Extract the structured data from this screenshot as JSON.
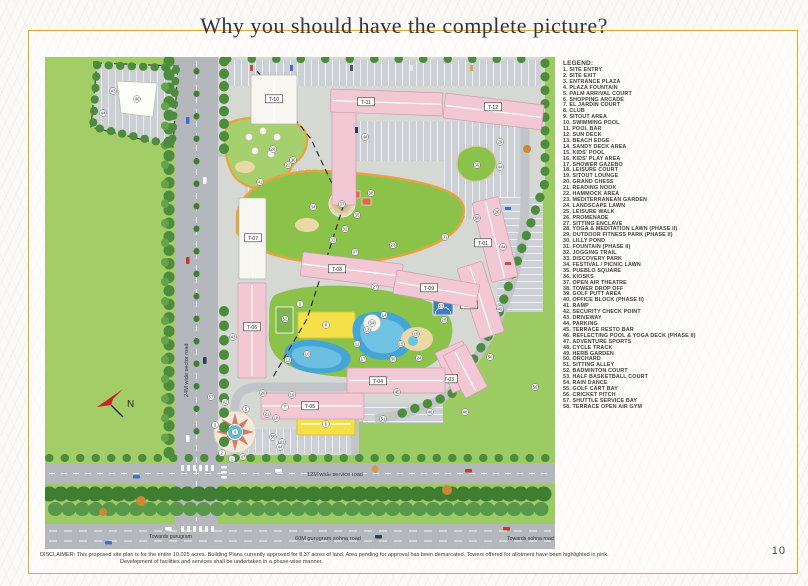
{
  "page": {
    "title": "Why you should have the complete picture?",
    "page_number": "10",
    "disclaimer": {
      "line1": "DISCLAIMER: This proposed site plan is for the entire 10.025 acres. Building Plans currently approved for 8.37 acres of land. Area pending for approval has been demarcated. Towers offered for allotment have been highlighted in pink.",
      "line2": "Development of facilities and services shall be undertaken in a phase-wise manner."
    }
  },
  "legend": {
    "heading": "LEGEND:",
    "items": [
      "1. SITE ENTRY",
      "2. SITE EXIT",
      "3. ENTRANCE PLAZA",
      "4. PLAZA FOUNTAIN",
      "5. PALM ARRIVAL COURT",
      "6. SHOPPING ARCADE",
      "7. EL JARDIN COURT",
      "8. CLUB",
      "9. SITOUT AREA",
      "10. SWIMMING POOL",
      "11. POOL BAR",
      "12. SUN DECK",
      "13. BEACH EDGE",
      "14. SANDY DECK AREA",
      "15. KIDS' POOL",
      "16. KIDS' PLAY AREA",
      "17. SHOWER GAZEBO",
      "18. LEISURE COURT",
      "19. SITOUT LOUNGE",
      "20. GRAND CHESS",
      "21. READING NOOK",
      "22. HAMMOCK AREA",
      "23. MEDITERRANEAN GARDEN",
      "24. LANDSCAPE LAWN",
      "25. LEISURE WALK",
      "26. PROMENADE",
      "27. SITTING ENCLAVE",
      "28. YOGA & MEDITATION LAWN (PHASE II)",
      "29. OUTDOOR FITNESS PARK (PHASE II)",
      "30. LILLY POND",
      "31. FOUNTAIN (PHASE II)",
      "32. JOGGING TRAIL",
      "33. DISCOVERY PARK",
      "34. FESTIVAL / PICNIC LAWN",
      "35. PUEBLO SQUARE",
      "36. KIOSKS",
      "37. OPEN AIR THEATRE",
      "38. TOWER DROP OFF",
      "39. GOLF PUTT AREA",
      "40. OFFICE BLOCK (PHASE II)",
      "41. RAMP",
      "42. SECURITY CHECK POINT",
      "43. DRIVEWAY",
      "44. PARKING",
      "45. TERRACE RESTO BAR",
      "46. REFLECTING POOL & YOGA DECK (PHASE II)",
      "47. ADVENTURE SPORTS",
      "48. CYCLE TRACK",
      "49. HERB GARDEN",
      "50. ORCHARD",
      "51. SITTING ALLEY",
      "52. BADMINTON COURT",
      "53. HALF BASKETBALL COURT",
      "54. RAIN DANCE",
      "55. GOLF CART BAY",
      "56. CRICKET PITCH",
      "57. SHUTTLE SERVICE BAY",
      "58. TERRACE OPEN AIR GYM"
    ]
  },
  "map": {
    "road_labels": {
      "sector": "24M wide sector road",
      "service": "12M wide service road",
      "sohna": "60M gurugram sohna road",
      "towards_gurugram": "Towards gurugram",
      "towards_sohna": "Towards sohna road"
    },
    "compass": "N",
    "colors": {
      "offered_tower_pink": "#f2c8d4",
      "phase2_white": "#f7f6f1",
      "grass": "#9ccb63",
      "road": "#b4b8bc",
      "pool": "#45a6d6",
      "club_yellow": "#f4e04b",
      "trail_orange": "#e8a33d"
    },
    "towers": [
      {
        "label": "T-01",
        "fill": "pink",
        "rect": [
          427,
          146,
          27,
          82
        ],
        "rot": -14,
        "lx": 438,
        "ly": 186
      },
      {
        "label": "T-02",
        "fill": "pink",
        "rect": [
          412,
          212,
          26,
          74
        ],
        "rot": -18,
        "lx": 424,
        "ly": 248
      },
      {
        "label": "T-03",
        "fill": "pink",
        "rect": [
          398,
          299,
          25,
          48
        ],
        "rot": -28,
        "lx": 404,
        "ly": 322
      },
      {
        "label": "T-04",
        "fill": "pink",
        "rect": [
          302,
          311,
          98,
          25
        ],
        "rot": 0,
        "lx": 333,
        "ly": 324
      },
      {
        "label": "T-05",
        "fill": "pink",
        "rect": [
          216,
          336,
          103,
          26
        ],
        "rot": 0,
        "lx": 265,
        "ly": 349
      },
      {
        "label": "T-06",
        "fill": "pink",
        "rect": [
          193,
          226,
          28,
          95
        ],
        "rot": 0,
        "lx": 207,
        "ly": 270
      },
      {
        "label": "T-07",
        "fill": "white",
        "rect": [
          194,
          141,
          27,
          81
        ],
        "rot": 0,
        "lx": 208,
        "ly": 181
      },
      {
        "label": "T-08",
        "fill": "pink",
        "rect": [
          258,
          195,
          101,
          24
        ],
        "rot": 7,
        "lx": 292,
        "ly": 212
      },
      {
        "label": "T-09",
        "fill": "pink",
        "rect": [
          352,
          213,
          84,
          24
        ],
        "rot": 10,
        "lx": 384,
        "ly": 231
      },
      {
        "label": "T-10",
        "fill": "white",
        "rect": [
          206,
          18,
          46,
          49
        ],
        "rot": 0,
        "lx": 229,
        "ly": 42
      },
      {
        "label": "T-11",
        "fill": "pink",
        "rect": [
          286,
          32,
          112,
          23
        ],
        "rot": 2,
        "lx": 321,
        "ly": 45
      },
      {
        "label": "T-12",
        "fill": "pink",
        "rect": [
          401,
          36,
          99,
          25
        ],
        "rot": 7,
        "lx": 448,
        "ly": 50
      }
    ],
    "markers": [
      {
        "n": "1",
        "x": 187,
        "y": 402
      },
      {
        "n": "2",
        "x": 177,
        "y": 396
      },
      {
        "n": "3",
        "x": 170,
        "y": 368
      },
      {
        "n": "4",
        "x": 190,
        "y": 375
      },
      {
        "n": "5",
        "x": 201,
        "y": 352
      },
      {
        "n": "6",
        "x": 281,
        "y": 367
      },
      {
        "n": "7",
        "x": 240,
        "y": 350
      },
      {
        "n": "8",
        "x": 281,
        "y": 268
      },
      {
        "n": "9",
        "x": 255,
        "y": 247
      },
      {
        "n": "10",
        "x": 262,
        "y": 297
      },
      {
        "n": "11",
        "x": 312,
        "y": 287
      },
      {
        "n": "12",
        "x": 243,
        "y": 303
      },
      {
        "n": "13",
        "x": 322,
        "y": 273
      },
      {
        "n": "14",
        "x": 339,
        "y": 258
      },
      {
        "n": "15",
        "x": 356,
        "y": 287
      },
      {
        "n": "16",
        "x": 371,
        "y": 277
      },
      {
        "n": "17",
        "x": 318,
        "y": 302
      },
      {
        "n": "18",
        "x": 231,
        "y": 361
      },
      {
        "n": "19",
        "x": 247,
        "y": 338
      },
      {
        "n": "20",
        "x": 218,
        "y": 336
      },
      {
        "n": "21",
        "x": 222,
        "y": 357
      },
      {
        "n": "22",
        "x": 243,
        "y": 108
      },
      {
        "n": "23",
        "x": 348,
        "y": 188
      },
      {
        "n": "24",
        "x": 374,
        "y": 301
      },
      {
        "n": "25",
        "x": 399,
        "y": 263
      },
      {
        "n": "26",
        "x": 452,
        "y": 155
      },
      {
        "n": "27",
        "x": 330,
        "y": 230
      },
      {
        "n": "28",
        "x": 228,
        "y": 92
      },
      {
        "n": "29",
        "x": 455,
        "y": 85
      },
      {
        "n": "30",
        "x": 348,
        "y": 302
      },
      {
        "n": "31",
        "x": 400,
        "y": 180
      },
      {
        "n": "32",
        "x": 300,
        "y": 172
      },
      {
        "n": "33",
        "x": 288,
        "y": 183
      },
      {
        "n": "34",
        "x": 268,
        "y": 150
      },
      {
        "n": "35",
        "x": 312,
        "y": 158
      },
      {
        "n": "36",
        "x": 248,
        "y": 103
      },
      {
        "n": "37",
        "x": 297,
        "y": 147
      },
      {
        "n": "38",
        "x": 326,
        "y": 136
      },
      {
        "n": "39",
        "x": 432,
        "y": 108
      },
      {
        "n": "40",
        "x": 92,
        "y": 42
      },
      {
        "n": "41",
        "x": 215,
        "y": 125
      },
      {
        "n": "41",
        "x": 237,
        "y": 385
      },
      {
        "n": "42",
        "x": 180,
        "y": 345
      },
      {
        "n": "43",
        "x": 68,
        "y": 34
      },
      {
        "n": "43",
        "x": 188,
        "y": 280
      },
      {
        "n": "44",
        "x": 58,
        "y": 56
      },
      {
        "n": "44",
        "x": 320,
        "y": 80
      },
      {
        "n": "44",
        "x": 455,
        "y": 110
      },
      {
        "n": "44",
        "x": 458,
        "y": 190
      },
      {
        "n": "44",
        "x": 235,
        "y": 390
      },
      {
        "n": "45",
        "x": 352,
        "y": 335
      },
      {
        "n": "46",
        "x": 385,
        "y": 355
      },
      {
        "n": "47",
        "x": 198,
        "y": 400
      },
      {
        "n": "47",
        "x": 310,
        "y": 195
      },
      {
        "n": "48",
        "x": 420,
        "y": 355
      },
      {
        "n": "49",
        "x": 455,
        "y": 252
      },
      {
        "n": "50",
        "x": 445,
        "y": 300
      },
      {
        "n": "51",
        "x": 338,
        "y": 362
      },
      {
        "n": "52",
        "x": 240,
        "y": 262
      },
      {
        "n": "53",
        "x": 396,
        "y": 249
      },
      {
        "n": "54",
        "x": 327,
        "y": 266
      },
      {
        "n": "55",
        "x": 228,
        "y": 380
      },
      {
        "n": "56",
        "x": 490,
        "y": 330
      },
      {
        "n": "57",
        "x": 166,
        "y": 340
      },
      {
        "n": "58",
        "x": 432,
        "y": 161
      }
    ]
  }
}
